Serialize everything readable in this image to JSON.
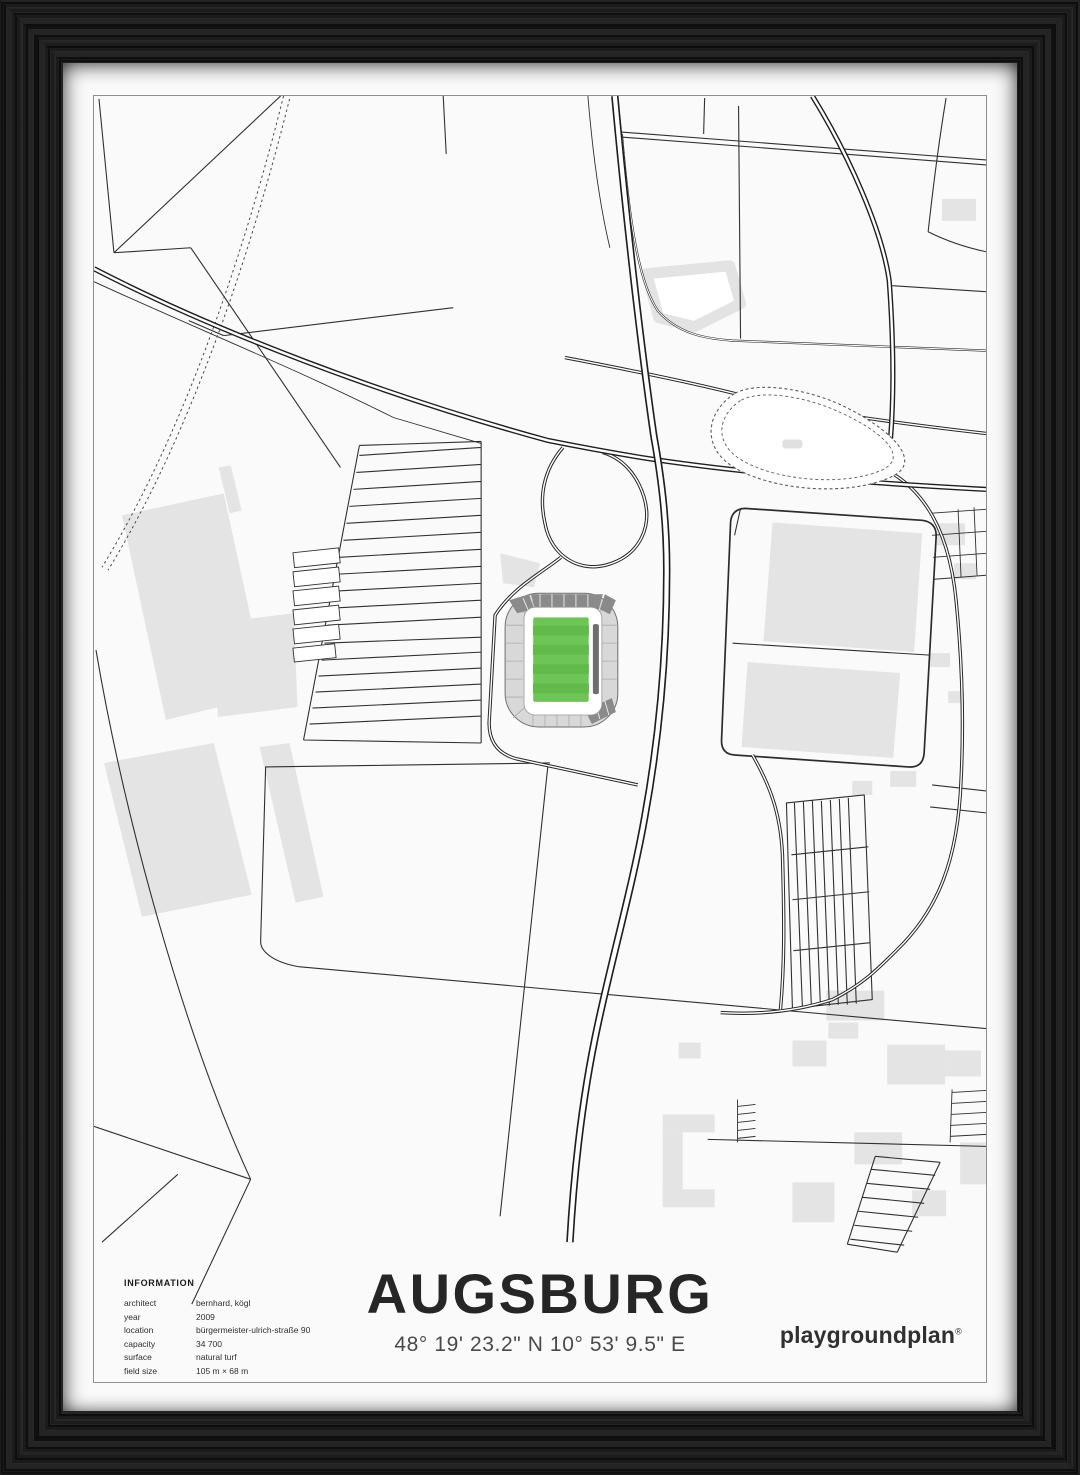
{
  "poster": {
    "title": "AUGSBURG",
    "coordinates": "48° 19' 23.2\" N  10° 53' 9.5\" E",
    "brand": "playgroundplan",
    "brand_mark": "®",
    "information": {
      "heading": "INFORMATION",
      "rows": [
        {
          "label": "architect",
          "value": "bernhard, kögl"
        },
        {
          "label": "year",
          "value": "2009"
        },
        {
          "label": "location",
          "value": "bürgermeister-ulrich-straße 90"
        },
        {
          "label": "capacity",
          "value": "34 700"
        },
        {
          "label": "surface",
          "value": "natural turf"
        },
        {
          "label": "field size",
          "value": "105 m × 68 m"
        }
      ]
    }
  },
  "colors": {
    "frame": "#1b1b1b",
    "paper": "#fafafa",
    "border_line": "#8f8f8f",
    "map_line": "#303030",
    "building_gray": "#e4e4e4",
    "stand_gray": "#d8d8d8",
    "stand_dark": "#8a8a8a",
    "roof_bar": "#6e6e6e",
    "pitch_green": "#6ec457",
    "pitch_stripe": "#61ba49"
  }
}
